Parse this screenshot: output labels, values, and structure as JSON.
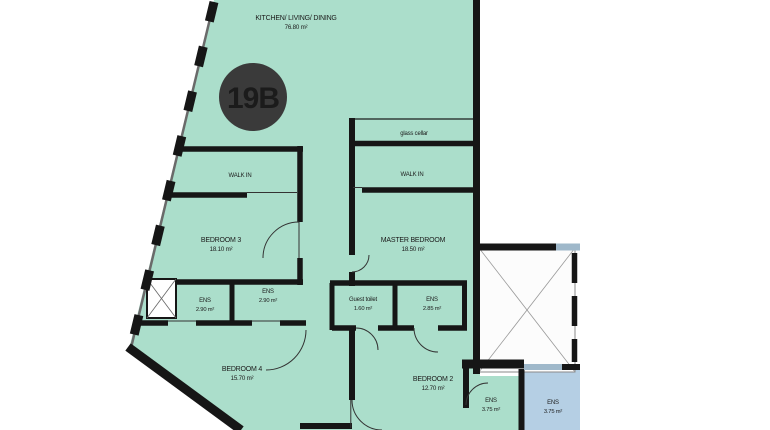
{
  "plan": {
    "unit_label": "19B",
    "rooms": [
      {
        "id": "kitchen-living-dining",
        "name": "KITCHEN/ LIVING/ DINING",
        "area": "76.80 m²"
      },
      {
        "id": "walk-in-left",
        "name": "WALK IN",
        "area": ""
      },
      {
        "id": "walk-in-right",
        "name": "WALK IN",
        "area": ""
      },
      {
        "id": "bedroom-3",
        "name": "BEDROOM 3",
        "area": "18.10 m²"
      },
      {
        "id": "master-bedroom",
        "name": "MASTER BEDROOM",
        "area": "18.50 m²"
      },
      {
        "id": "ens-left",
        "name": "ENS",
        "area": "2.90 m²"
      },
      {
        "id": "ens-right",
        "name": "ENS",
        "area": "2.90 m²"
      },
      {
        "id": "guest-toilet",
        "name": "Guest toilet",
        "area": "1.60 m²"
      },
      {
        "id": "ens-master",
        "name": "ENS",
        "area": "2.85 m²"
      },
      {
        "id": "bedroom-4",
        "name": "BEDROOM 4",
        "area": "15.70 m²"
      },
      {
        "id": "bedroom-2",
        "name": "BEDROOM 2",
        "area": "12.70 m²"
      },
      {
        "id": "ens-bedroom2",
        "name": "ENS",
        "area": "3.75 m²"
      },
      {
        "id": "ens-adjacent",
        "name": "ENS",
        "area": "3.75 m²"
      }
    ],
    "annotations": {
      "glass_cellar": "glass cellar"
    },
    "colors": {
      "unit_fill": "#abdecb",
      "adjacent_fill": "#b5cfe4",
      "wall": "#161616",
      "light_wall": "#9fb8ca",
      "badge_bg": "#3a3a3a",
      "badge_text": "#ffffff",
      "background": "#ffffff"
    }
  }
}
